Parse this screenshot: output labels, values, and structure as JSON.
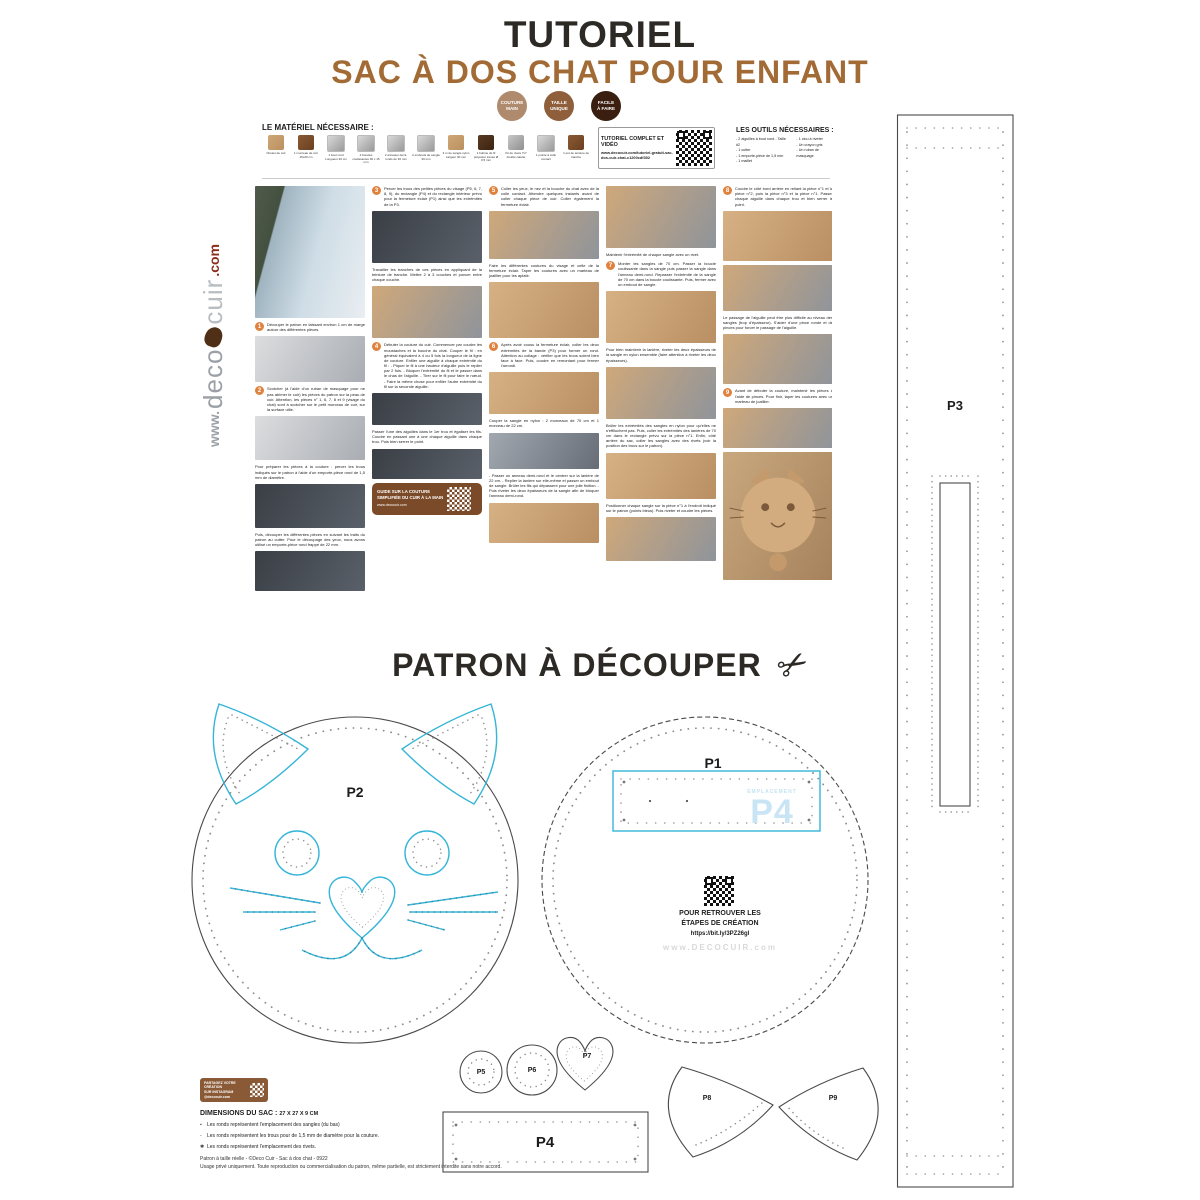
{
  "page": {
    "title": "TUTORIEL",
    "subtitle": "SAC À DOS CHAT POUR ENFANT",
    "badges": [
      {
        "line1": "COUTURE",
        "line2": "MAIN",
        "color": "#b08a6d"
      },
      {
        "line1": "TAILLE",
        "line2": "UNIQUE",
        "color": "#8f5f3c"
      },
      {
        "line1": "FACILE",
        "line2": "À FAIRE",
        "color": "#3a1f10"
      }
    ],
    "accent_colors": {
      "brown": "#a26b35",
      "cyan": "#35b5d8",
      "orange": "#e0823f",
      "dark": "#2d2a26"
    }
  },
  "materials": {
    "heading": "LE MATÉRIEL NÉCESSAIRE :",
    "items": [
      {
        "label": "Chutes de cuir",
        "tone": "tan"
      },
      {
        "label": "1 morceau de cuir 15x20 cm",
        "tone": "brown"
      },
      {
        "label": "1 bout rond Longueur 20 cm",
        "tone": "metal"
      },
      {
        "label": "2 boucles coulissantes 30 x 15 mm",
        "tone": "metal"
      },
      {
        "label": "2 anneaux demi-ronds de 30 mm",
        "tone": "metal"
      },
      {
        "label": "2 embouts de sangle 30 mm",
        "tone": "metal"
      },
      {
        "label": "3 m de sangle nylon Largeur 30 mm",
        "tone": "tan"
      },
      {
        "label": "1 bobine de fil polyester tressé Ø 0,5 mm",
        "tone": "darkb"
      },
      {
        "label": "Kit de rivets 7x7 double calotte",
        "tone": "grey"
      },
      {
        "label": "1 pointe à colle contact",
        "tone": "metal"
      },
      {
        "label": "1 pot de teinture de tranche",
        "tone": "brown"
      }
    ]
  },
  "video_box": {
    "title": "TUTORIEL COMPLET ET VIDÉO",
    "url": "www.decocuir.com/tutoriel-gratuit-sac-dos-cuir-chat-c1200cdf302"
  },
  "tools": {
    "heading": "LES OUTILS NÉCESSAIRES :",
    "col1": [
      "2 aiguilles à bout rond - Taille #2",
      "1 cutter",
      "1 emporte-pièce de 1,5 mm",
      "1 maillet"
    ],
    "col2": [
      "1 clou à riveter",
      "Un crayon gris",
      "Un ruban de masquage"
    ]
  },
  "logo": {
    "www": "www.",
    "deco": "deco",
    "cuir": "cuir",
    "com": ".com"
  },
  "guide_box": {
    "line1": "GUIDE SUR LA COUTURE",
    "line2": "SIMPLIFIÉE DU CUIR À LA MAIN",
    "url": "www.decocuir.com"
  },
  "tutorial": {
    "columns": [
      {
        "blocks": [
          {
            "t": "photo",
            "h": 132,
            "tone": "street"
          },
          {
            "t": "step",
            "n": "1",
            "text": "Découper le patron en laissant environ 1 cm de marge autour des différentes pièces."
          },
          {
            "t": "photo",
            "h": 46,
            "tone": "paper"
          },
          {
            "t": "step",
            "n": "2",
            "text": "Scotcher (à l'aide d'un ruban de masquage pour ne pas abîmer le cuir) les pièces du patron sur la peau de cuir. Attention, les pièces n° 1, 6, 7, 8 et 9 (visage du chat) sont à scotcher sur le petit morceau de cuir, sur la surface utile."
          },
          {
            "t": "photo",
            "h": 44,
            "tone": "paper"
          },
          {
            "t": "text",
            "text": "Pour préparer les pièces à la couture : percer les trous indiqués sur le patron à l'aide d'un emporte-pièce rond de 1,5 mm de diamètre."
          },
          {
            "t": "photo",
            "h": 44,
            "tone": "dark"
          },
          {
            "t": "text",
            "text": "Puis, découper les différentes pièces en suivant les traits du patron au cutter. Pour le découpage des yeux, nous avons utilisé un emporte-pièce rond frappé de 22 mm."
          },
          {
            "t": "photo",
            "h": 40,
            "tone": "dark"
          }
        ]
      },
      {
        "blocks": [
          {
            "t": "step",
            "n": "3",
            "text": "Percer les trous des petites pièces du visage (P5, 6, 7, 8, 9), du rectangle (P4) et du rectangle intérieur prévu pour la fermeture éclair (P1) ainsi que les extrémités de la P3."
          },
          {
            "t": "photo",
            "h": 52,
            "tone": "dark"
          },
          {
            "t": "text",
            "text": "Travailler les tranches de ces pièces en appliquant de la teinture de tranche. Mettre 2 à 3 couches et poncer entre chaque couche."
          },
          {
            "t": "photo",
            "h": 52,
            "tone": "hands"
          },
          {
            "t": "step",
            "n": "4",
            "text": "Débuter la couture du cuir. Commencer par coudre les moustaches et la bouche du chat. Couper le fil : en général équivalent à 4 ou 5 fois la longueur de la ligne de couture. Enfiler une aiguille à chaque extrémité du fil : - Piquer le fil à une hauteur d'aiguille puis le replier par 2 fois. - Bloquer l'extrémité du fil et le passer dans le chas de l'aiguille. - Tirer sur le fil pour faire le nœud. - Faire la même chose pour enfiler l'autre extrémité du fil sur la seconde aiguille."
          },
          {
            "t": "photo",
            "h": 32,
            "tone": "dark"
          },
          {
            "t": "text",
            "text": "Passer l'une des aiguilles dans le 1er trou et égaliser les fils. Coudre en passant une à une chaque aiguille dans chaque trou. Puis bien serrer le point."
          },
          {
            "t": "photo",
            "h": 30,
            "tone": "dark"
          },
          {
            "t": "guide"
          }
        ]
      },
      {
        "blocks": [
          {
            "t": "step",
            "n": "5",
            "text": "Coller les yeux, le nez et la bouche du chat avec de la colle contact. Attendre quelques instants avant de coller chaque pièce de cuir. Coller également la fermeture éclair."
          },
          {
            "t": "photo",
            "h": 48,
            "tone": "hands"
          },
          {
            "t": "text",
            "text": "Faire les différentes coutures du visage et celle de la fermeture éclair. Taper les coutures avec un marteau de joaillier pour les aplatir."
          },
          {
            "t": "photo",
            "h": 56,
            "tone": "tanp"
          },
          {
            "t": "step",
            "n": "6",
            "text": "Après avoir cousu la fermeture éclair, coller les deux extrémités de la bande (P3) pour former un rond. Attention au collage : vérifier que les trous soient bien face à face. Puis, coudre en remontant pour fermer l'arrondi."
          },
          {
            "t": "photo",
            "h": 42,
            "tone": "tanp"
          },
          {
            "t": "text",
            "text": "Couper la sangle en nylon : 2 morceaux de 70 cm et 1 morceau de 22 cm."
          },
          {
            "t": "photo",
            "h": 36,
            "tone": "tools"
          },
          {
            "t": "text",
            "text": "- Passer un anneau demi-rond et le centrer sur la lanière de 22 cm. - Replier la lanière sur elle-même et passer un embout de sangle. Brûler les fils qui dépassent pour une jolie finition. - Puis riveter les deux épaisseurs de la sangle afin de bloquer l'anneau demi-rond."
          },
          {
            "t": "photo",
            "h": 40,
            "tone": "tanp"
          }
        ]
      },
      {
        "blocks": [
          {
            "t": "photo",
            "h": 62,
            "tone": "hands"
          },
          {
            "t": "text",
            "text": "Maintenir l'extrémité de chaque sangle avec un rivet."
          },
          {
            "t": "step",
            "n": "7",
            "text": "Monter les sangles de 70 cm. Passer la boucle coulissante dans la sangle puis passer la sangle dans l'anneau demi-rond. Repasser l'extrémité de la sangle de 70 cm dans la boucle coulissante. Puis, fermer avec un embout de sangle."
          },
          {
            "t": "photo",
            "h": 52,
            "tone": "tanp"
          },
          {
            "t": "text",
            "text": "Pour bien maintenir la lanière, riveter les deux épaisseurs de la sangle en nylon ensemble (faire attention à riveter les deux épaisseurs)."
          },
          {
            "t": "photo",
            "h": 52,
            "tone": "hands"
          },
          {
            "t": "text",
            "text": "Brûler les extrémités des sangles en nylon pour qu'elles ne s'effilochent pas. Puis, coller les extrémités des lanières de 70 cm dans le rectangle prévu sur la pièce n°1. Enfin, côté arrière du sac, coller les sangles avec des rivets (voir la position des trous sur le patron)."
          },
          {
            "t": "photo",
            "h": 46,
            "tone": "tanp"
          },
          {
            "t": "text",
            "text": "Positionner chaque sangle sur la pièce n°1 à l'endroit indiqué sur le patron (points bleus). Puis riveter et coudre les pièces."
          },
          {
            "t": "photo",
            "h": 44,
            "tone": "hands"
          }
        ]
      },
      {
        "blocks": [
          {
            "t": "step",
            "n": "8",
            "text": "Coudre le côté bord arrière en reliant la pièce n°1 et la pièce n°2, puis la pièce n°3 et la pièce n°1. Passer chaque aiguille dans chaque trou et bien serrer le point."
          },
          {
            "t": "photo",
            "h": 50,
            "tone": "tanp"
          },
          {
            "t": "photo",
            "h": 46,
            "tone": "hands"
          },
          {
            "t": "text",
            "text": "Le passage de l'aiguille peut être plus difficile au niveau des sangles (trop d'épaisseur). S'aider d'une pince ronde et de pinces pour forcer le passage de l'aiguille."
          },
          {
            "t": "photo",
            "h": 50,
            "tone": "hands"
          },
          {
            "t": "step",
            "n": "9",
            "text": "Avant de débuter la couture, maintenir les pièces à l'aide de pinces. Pour finir, taper les coutures avec un marteau de joaillier."
          },
          {
            "t": "photo",
            "h": 40,
            "tone": "hands"
          },
          {
            "t": "catphoto",
            "h": 128
          }
        ]
      }
    ]
  },
  "patron": {
    "heading": "PATRON À DÉCOUPER",
    "scissors": "✂"
  },
  "patterns": {
    "p1": {
      "label": "P1"
    },
    "p2": {
      "label": "P2"
    },
    "p3": {
      "label": "P3"
    },
    "p4": {
      "label": "P4"
    },
    "p5": {
      "label": "P5"
    },
    "p6": {
      "label": "P6"
    },
    "p7": {
      "label": "P7"
    },
    "p8": {
      "label": "P8"
    },
    "p9": {
      "label": "P9"
    },
    "p1_inner": {
      "small": "EMPLACEMENT",
      "big": "P4"
    },
    "qr_block": {
      "line1": "POUR RETROUVER LES",
      "line2": "ÉTAPES DE CRÉATION",
      "url": "https://bit.ly/3PZ26gl",
      "watermark": "www.DECOCUIR.com"
    }
  },
  "footer": {
    "share_box": {
      "line1": "PARTAGEZ VOTRE CRÉATION",
      "line2": "SUR INSTAGRAM",
      "line3": "@decocuir.com"
    },
    "dimensions_label": "DIMENSIONS DU SAC :",
    "dimensions_value": "27 X 27 X 9 CM",
    "legend": [
      {
        "marker": "▪",
        "text": "Les ronds représentent l'emplacement des sangles (du bas)"
      },
      {
        "marker": "-",
        "text": "Les ronds représentent les trous pour de 1,5 mm de diamètre pour la couture."
      },
      {
        "marker": "✱",
        "text": "Les ronds représentent l'emplacement des rivets."
      }
    ],
    "copyright1": "Patron à taille réelle - ©Deco Cuir - Sac à dos chat - 0922",
    "copyright2": "Usage privé uniquement. Toute reproduction ou commercialisation du patron, même partielle, est strictement interdite sans notre accord."
  }
}
